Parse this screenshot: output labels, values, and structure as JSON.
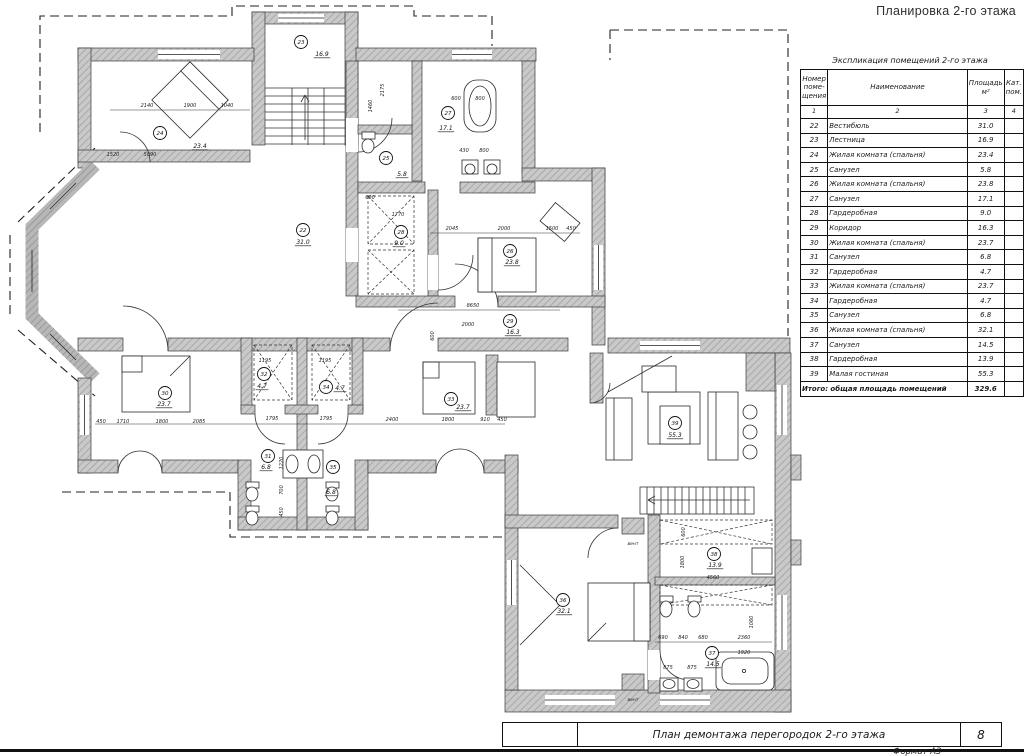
{
  "sheet": {
    "top_title": "Планировка 2-го этажа"
  },
  "schedule": {
    "caption": "Экспликация помещений 2-го этажа",
    "headers": {
      "num": "Номер\nпоме-\nщения",
      "name": "Наименование",
      "area": "Площадь\nм²",
      "cat": "Кат.\nпом."
    },
    "index_row": [
      "1",
      "2",
      "3",
      "4"
    ],
    "rows": [
      [
        "22",
        "Вестибюль",
        "31.0"
      ],
      [
        "23",
        "Лестница",
        "16.9"
      ],
      [
        "24",
        "Жилая комната (спальня)",
        "23.4"
      ],
      [
        "25",
        "Санузел",
        "5.8"
      ],
      [
        "26",
        "Жилая комната (спальня)",
        "23.8"
      ],
      [
        "27",
        "Санузел",
        "17.1"
      ],
      [
        "28",
        "Гардеробная",
        "9.0"
      ],
      [
        "29",
        "Коридор",
        "16.3"
      ],
      [
        "30",
        "Жилая комната (спальня)",
        "23.7"
      ],
      [
        "31",
        "Санузел",
        "6.8"
      ],
      [
        "32",
        "Гардеробная",
        "4.7"
      ],
      [
        "33",
        "Жилая комната (спальня)",
        "23.7"
      ],
      [
        "34",
        "Гардеробная",
        "4.7"
      ],
      [
        "35",
        "Санузел",
        "6.8"
      ],
      [
        "36",
        "Жилая комната (спальня)",
        "32.1"
      ],
      [
        "37",
        "Санузел",
        "14.5"
      ],
      [
        "38",
        "Гардеробная",
        "13.9"
      ],
      [
        "39",
        "Малая гостиная",
        "55.3"
      ]
    ],
    "total_label": "Итого: общая площадь помещений",
    "total_value": "329.6"
  },
  "plan": {
    "rooms": [
      {
        "num": "23",
        "area": "16.9",
        "x": 301,
        "y": 42,
        "ax": 322,
        "ay": 56
      },
      {
        "num": "24",
        "area": "23.4",
        "x": 160,
        "y": 133,
        "ax": 200,
        "ay": 148
      },
      {
        "num": "27",
        "area": "17.1",
        "x": 448,
        "y": 113,
        "ax": 446,
        "ay": 130
      },
      {
        "num": "25",
        "area": "5.8",
        "x": 386,
        "y": 158,
        "ax": 402,
        "ay": 176
      },
      {
        "num": "22",
        "area": "31.0",
        "x": 303,
        "y": 230,
        "ax": 303,
        "ay": 244
      },
      {
        "num": "28",
        "area": "9.0",
        "x": 401,
        "y": 232,
        "ax": 399,
        "ay": 245
      },
      {
        "num": "26",
        "area": "23.8",
        "x": 510,
        "y": 251,
        "ax": 512,
        "ay": 264
      },
      {
        "num": "29",
        "area": "16.3",
        "x": 510,
        "y": 321,
        "ax": 513,
        "ay": 334
      },
      {
        "num": "30",
        "area": "23.7",
        "x": 165,
        "y": 393,
        "ax": 164,
        "ay": 406
      },
      {
        "num": "32",
        "area": "4.7",
        "x": 264,
        "y": 374,
        "ax": 262,
        "ay": 388
      },
      {
        "num": "34",
        "area": "4.7",
        "x": 326,
        "y": 387,
        "ax": 340,
        "ay": 390
      },
      {
        "num": "31",
        "area": "6.8",
        "x": 268,
        "y": 456,
        "ax": 266,
        "ay": 469
      },
      {
        "num": "35",
        "area": "6.8",
        "x": 333,
        "y": 467,
        "ax": 331,
        "ay": 494
      },
      {
        "num": "33",
        "area": "23.7",
        "x": 451,
        "y": 399,
        "ax": 463,
        "ay": 409
      },
      {
        "num": "39",
        "area": "55.3",
        "x": 675,
        "y": 423,
        "ax": 675,
        "ay": 437
      },
      {
        "num": "36",
        "area": "32.1",
        "x": 563,
        "y": 600,
        "ax": 564,
        "ay": 613
      },
      {
        "num": "38",
        "area": "13.9",
        "x": 714,
        "y": 554,
        "ax": 715,
        "ay": 567
      },
      {
        "num": "37",
        "area": "14.5",
        "x": 712,
        "y": 653,
        "ax": 713,
        "ay": 666
      }
    ],
    "dims": [
      {
        "t": "2140",
        "x": 147,
        "y": 107
      },
      {
        "t": "1900",
        "x": 190,
        "y": 107
      },
      {
        "t": "1040",
        "x": 227,
        "y": 107
      },
      {
        "t": "1520",
        "x": 113,
        "y": 156
      },
      {
        "t": "5090",
        "x": 150,
        "y": 156
      },
      {
        "t": "2175",
        "x": 384,
        "y": 90,
        "v": 1
      },
      {
        "t": "1460",
        "x": 372,
        "y": 106,
        "v": 1
      },
      {
        "t": "600",
        "x": 456,
        "y": 100
      },
      {
        "t": "800",
        "x": 480,
        "y": 100
      },
      {
        "t": "430",
        "x": 464,
        "y": 152
      },
      {
        "t": "800",
        "x": 484,
        "y": 152
      },
      {
        "t": "600",
        "x": 370,
        "y": 199
      },
      {
        "t": "1770",
        "x": 398,
        "y": 216
      },
      {
        "t": "2045",
        "x": 452,
        "y": 230
      },
      {
        "t": "2000",
        "x": 504,
        "y": 230
      },
      {
        "t": "1500",
        "x": 552,
        "y": 230
      },
      {
        "t": "450",
        "x": 571,
        "y": 230
      },
      {
        "t": "8650",
        "x": 473,
        "y": 307
      },
      {
        "t": "2000",
        "x": 468,
        "y": 326
      },
      {
        "t": "600",
        "x": 434,
        "y": 336,
        "v": 1
      },
      {
        "t": "450",
        "x": 101,
        "y": 423
      },
      {
        "t": "1710",
        "x": 123,
        "y": 423
      },
      {
        "t": "1800",
        "x": 162,
        "y": 423
      },
      {
        "t": "2085",
        "x": 199,
        "y": 423
      },
      {
        "t": "1195",
        "x": 265,
        "y": 362
      },
      {
        "t": "1195",
        "x": 325,
        "y": 362
      },
      {
        "t": "1795",
        "x": 272,
        "y": 420
      },
      {
        "t": "1795",
        "x": 326,
        "y": 420
      },
      {
        "t": "2400",
        "x": 392,
        "y": 421
      },
      {
        "t": "1800",
        "x": 448,
        "y": 421
      },
      {
        "t": "910",
        "x": 485,
        "y": 421
      },
      {
        "t": "450",
        "x": 502,
        "y": 421
      },
      {
        "t": "1220",
        "x": 283,
        "y": 463,
        "v": 1
      },
      {
        "t": "700",
        "x": 283,
        "y": 490,
        "v": 1
      },
      {
        "t": "450",
        "x": 283,
        "y": 512,
        "v": 1
      },
      {
        "t": "4560",
        "x": 713,
        "y": 579
      },
      {
        "t": "600",
        "x": 685,
        "y": 532,
        "v": 1
      },
      {
        "t": "1800",
        "x": 684,
        "y": 562,
        "v": 1
      },
      {
        "t": "690",
        "x": 663,
        "y": 639
      },
      {
        "t": "840",
        "x": 683,
        "y": 639
      },
      {
        "t": "680",
        "x": 703,
        "y": 639
      },
      {
        "t": "2360",
        "x": 744,
        "y": 639
      },
      {
        "t": "1060",
        "x": 753,
        "y": 622,
        "v": 1
      },
      {
        "t": "1920",
        "x": 744,
        "y": 654
      },
      {
        "t": "875",
        "x": 668,
        "y": 669
      },
      {
        "t": "875",
        "x": 692,
        "y": 669
      }
    ],
    "vents": [
      {
        "label": "вент",
        "x": 633,
        "y": 545
      },
      {
        "label": "вент",
        "x": 633,
        "y": 701
      }
    ]
  },
  "titleblock": {
    "doc_title": "План демонтажа перегородок 2-го этажа",
    "sheet_number": "8",
    "format_note": "Формат А3"
  }
}
